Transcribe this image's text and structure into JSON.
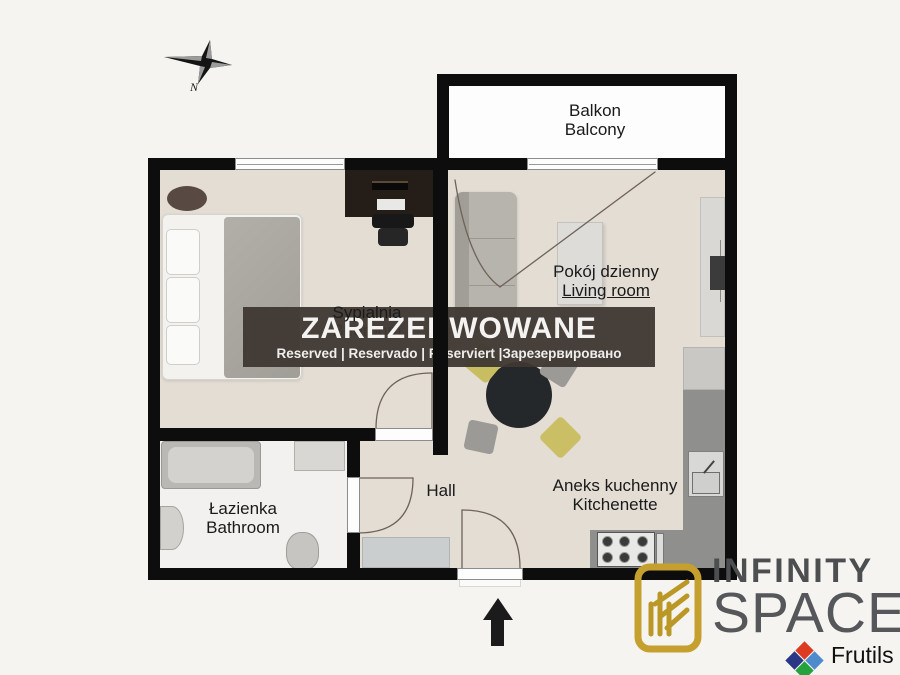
{
  "compass": {
    "label": "N"
  },
  "reservation_banner": {
    "title": "ZAREZERWOWANE",
    "subtitle": "Reserved | Reservado | Reserviert |Зарезервировано"
  },
  "rooms": {
    "balcony": {
      "name_pl": "Balkon",
      "name_en": "Balcony"
    },
    "bedroom": {
      "name_pl": "Sypialnia",
      "name_en": "Bedroom"
    },
    "living_room": {
      "name_pl": "Pokój dzienny",
      "name_en": "Living room"
    },
    "bathroom": {
      "name_pl": "Łazienka",
      "name_en": "Bathroom"
    },
    "hall": {
      "name_pl": "Hall"
    },
    "kitchenette": {
      "name_pl": "Aneks kuchenny",
      "name_en": "Kitchenette"
    }
  },
  "branding": {
    "company_line1": "INFINITY",
    "company_line2": "SPACE",
    "partner": "Frutils",
    "colors": {
      "gold": "#c5a02f",
      "text_gray": "#4c4e50",
      "diamond_red": "#dd3a22",
      "diamond_dark_blue": "#2a3784",
      "diamond_light_blue": "#4e8bcd",
      "diamond_green": "#23a23f"
    }
  },
  "palette": {
    "wall": "#0d0d0d",
    "floor_beige": "#e3ddd4",
    "bathroom_floor": "#f2f1ef",
    "balcony_floor": "#fdfdfd",
    "kitchen_counter": "#8f8f8d",
    "banner_bg": "rgba(62,55,50,0.95)",
    "cushion_yellow": "#c9bd62",
    "sofa_gray": "#b7b3ad"
  }
}
